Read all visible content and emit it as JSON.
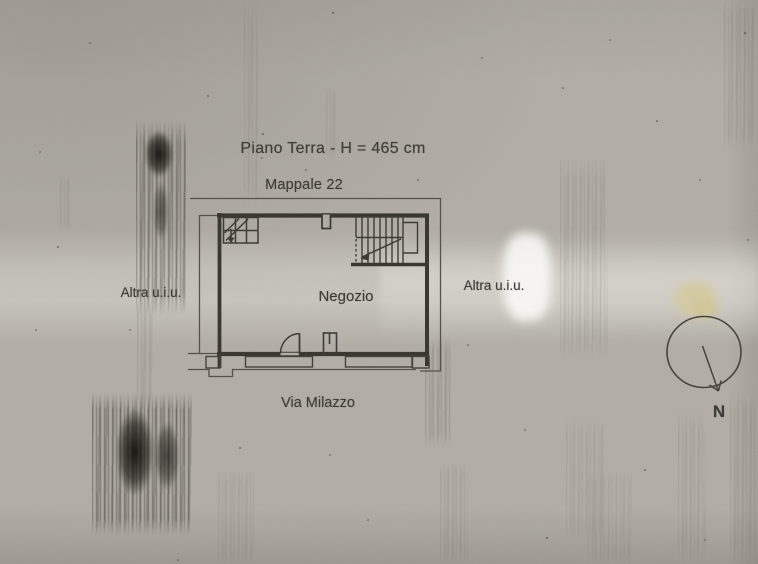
{
  "photo": {
    "floor_title": "Piano Terra - H = 465 cm",
    "parcel_label": "Mappale 22",
    "room_label": "Negozio",
    "adjacent_unit_left": "Altra u.i.u.",
    "adjacent_unit_right": "Altra u.i.u.",
    "street_label": "Via Milazzo",
    "north_label": "N"
  },
  "colors": {
    "paper": "#b4b0a8",
    "ink": "#3b3833",
    "boundary_line": "#56524b",
    "highlight_patch": "#d8cc9c"
  }
}
